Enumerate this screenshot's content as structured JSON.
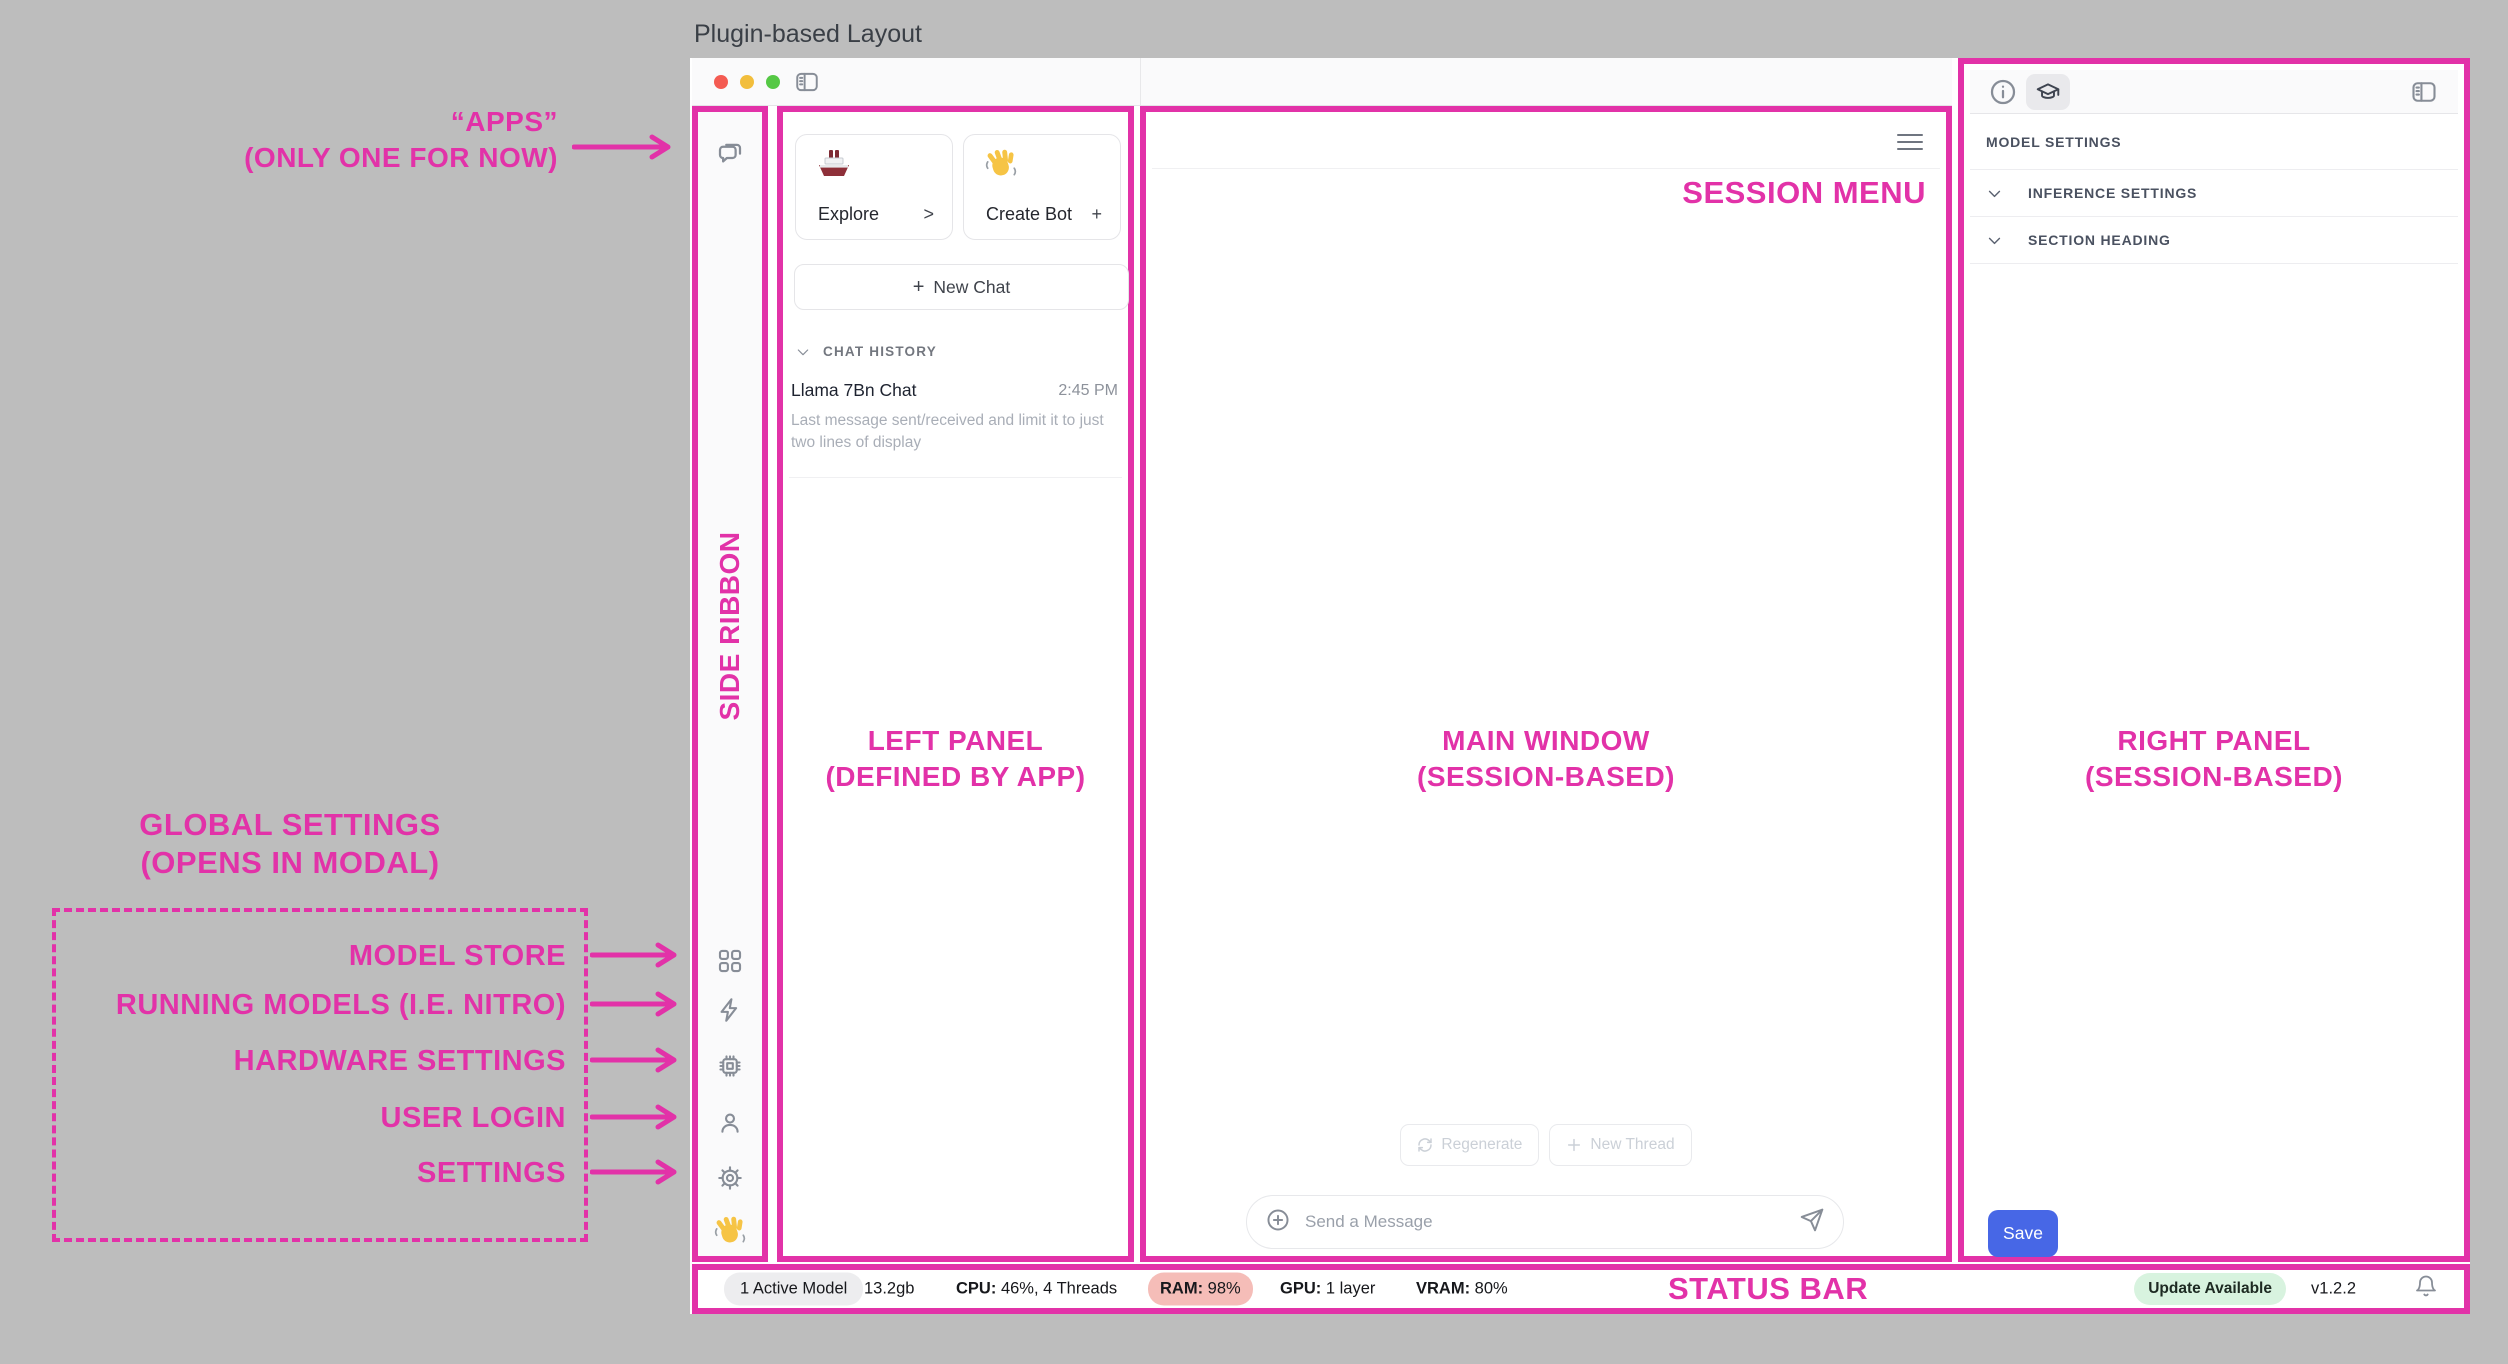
{
  "colors": {
    "accent": "#E232A8",
    "canvas_background": "#BDBDBD",
    "save_button": "#4767E6",
    "ram_badge_bg": "#F5BDB8",
    "update_badge_bg": "#D8F3DF",
    "traffic_red": "#F45B52",
    "traffic_yellow": "#F2BE3C",
    "traffic_green": "#55C845"
  },
  "icons": {
    "ribbon": [
      "chat-bubbles-icon",
      "grid-icon",
      "bolt-icon",
      "chip-icon",
      "user-icon",
      "gear-icon",
      "waving-hand-emoji"
    ],
    "toolbar": [
      "toggle-left-panel-icon"
    ],
    "right_panel_header": [
      "info-icon",
      "graduation-cap-icon",
      "toggle-right-panel-icon"
    ],
    "composer": [
      "circle-plus-icon",
      "send-icon"
    ],
    "status": [
      "bell-icon"
    ]
  },
  "page": {
    "title": "Plugin-based Layout"
  },
  "annotations": {
    "apps": {
      "line1": "“APPS”",
      "line2": "(ONLY ONE FOR NOW)"
    },
    "side_ribbon": "SIDE RIBBON",
    "global": {
      "line1": "GLOBAL SETTINGS",
      "line2": "(OPENS IN MODAL)",
      "items": [
        {
          "label": "MODEL STORE"
        },
        {
          "label": "RUNNING MODELS (I.E. NITRO)"
        },
        {
          "label": "HARDWARE SETTINGS"
        },
        {
          "label": "USER LOGIN"
        },
        {
          "label": "SETTINGS"
        }
      ]
    },
    "left_panel": {
      "line1": "LEFT PANEL",
      "line2": "(DEFINED BY APP)"
    },
    "main_window": {
      "line1": "MAIN WINDOW",
      "line2": "(SESSION-BASED)"
    },
    "right_panel": {
      "line1": "RIGHT PANEL",
      "line2": "(SESSION-BASED)"
    },
    "session_menu": "SESSION MENU",
    "status_bar": "STATUS BAR"
  },
  "left_panel": {
    "cards": [
      {
        "emoji": "ship-emoji",
        "label": "Explore",
        "affordance": ">"
      },
      {
        "emoji": "waving-hand-emoji",
        "label": "Create Bot",
        "affordance": "+"
      }
    ],
    "new_chat": {
      "plus": "+",
      "label": "New Chat"
    },
    "chat_history_heading": "CHAT HISTORY",
    "chats": [
      {
        "title": "Llama 7Bn Chat",
        "time": "2:45 PM",
        "preview": "Last message sent/received and limit it to just two lines of display"
      }
    ]
  },
  "main": {
    "regenerate_label": "Regenerate",
    "new_thread_label": "New Thread",
    "composer_placeholder": "Send a Message"
  },
  "right_panel": {
    "model_settings_heading": "MODEL SETTINGS",
    "sections": [
      {
        "label": "INFERENCE SETTINGS"
      },
      {
        "label": "SECTION HEADING"
      }
    ],
    "save_label": "Save"
  },
  "status_bar": {
    "active_model": "1 Active Model",
    "memory": "13.2gb",
    "cpu_label": "CPU:",
    "cpu_value": "46%, 4 Threads",
    "ram_label": "RAM:",
    "ram_value": "98%",
    "gpu_label": "GPU:",
    "gpu_value": "1 layer",
    "vram_label": "VRAM:",
    "vram_value": "80%",
    "update_badge": "Update Available",
    "version": "v1.2.2"
  }
}
